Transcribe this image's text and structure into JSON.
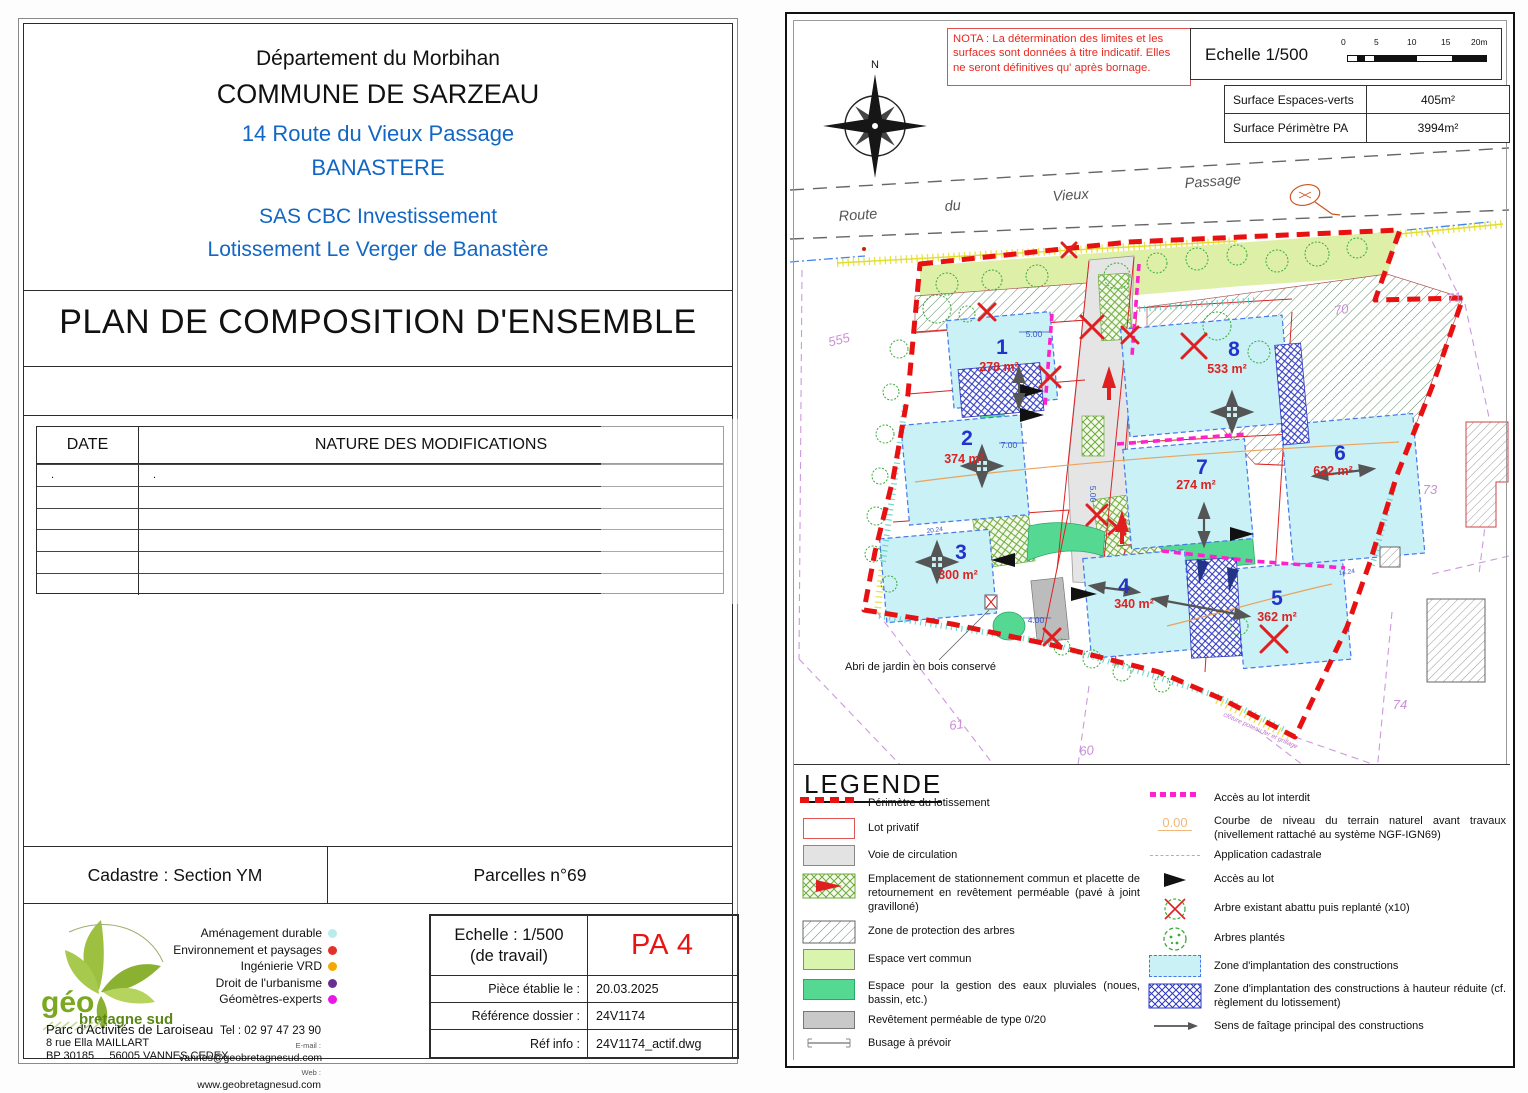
{
  "left_panel": {
    "header": {
      "line1": "Département du Morbihan",
      "line2": "COMMUNE DE SARZEAU",
      "line3": "14 Route du Vieux Passage",
      "line4": "BANASTERE",
      "line5": "SAS CBC Investissement",
      "line6": "Lotissement Le Verger de Banastère"
    },
    "title": "PLAN DE COMPOSITION D'ENSEMBLE",
    "modifications_table": {
      "col_date": "DATE",
      "col_nature": "NATURE DES MODIFICATIONS",
      "row1_date": ".",
      "row1_nature": "."
    },
    "cadastre": "Cadastre : Section YM",
    "parcelles": "Parcelles n°69",
    "logo": {
      "name": "géo",
      "sub": "bretagne sud"
    },
    "services": [
      {
        "label": "Aménagement durable",
        "color": "#b8ecec"
      },
      {
        "label": "Environnement et paysages",
        "color": "#e23128"
      },
      {
        "label": "Ingénierie VRD",
        "color": "#f5a800"
      },
      {
        "label": "Droit de l'urbanisme",
        "color": "#6a2d91"
      },
      {
        "label": "Géomètres-experts",
        "color": "#e619e6"
      }
    ],
    "contact": {
      "line1": "Parc d'Activités de Laroiseau",
      "line2": "8 rue Ella MAILLART",
      "line3a": "BP 30185",
      "line3b": "56005 VANNES CEDEX",
      "tel": "Tel : 02 97 47 23 90",
      "email_label": "E-mail :",
      "email": "vannes@geobretagnesud.com",
      "web_label": "Web :",
      "web": "www.geobretagnesud.com"
    },
    "info_table": {
      "echelle_line1": "Echelle : 1/500",
      "echelle_line2": "(de travail)",
      "doc_code": "PA 4",
      "rows": [
        {
          "label": "Pièce établie le :",
          "value": "20.03.2025"
        },
        {
          "label": "Référence dossier :",
          "value": "24V1174"
        },
        {
          "label": "Réf info :",
          "value": "24V1174_actif.dwg"
        }
      ]
    }
  },
  "right_panel": {
    "nota": "NOTA : La détermination des limites et les surfaces sont données à titre indicatif. Elles ne  seront définitives qu' après bornage.",
    "scale": {
      "label": "Echelle 1/500",
      "ticks": [
        "0",
        "5",
        "10",
        "15",
        "20m"
      ]
    },
    "surface_table": [
      {
        "label": "Surface Espaces-verts",
        "value": "405m²"
      },
      {
        "label": "Surface Périmètre PA",
        "value": "3994m²"
      }
    ],
    "compass": "N",
    "road_words": [
      "Route",
      "du",
      "Vieux",
      "Passage"
    ],
    "lots": [
      {
        "num": "1",
        "area": "278 m²"
      },
      {
        "num": "2",
        "area": "374 m²"
      },
      {
        "num": "3",
        "area": "300 m²"
      },
      {
        "num": "4",
        "area": "340 m²"
      },
      {
        "num": "5",
        "area": "362 m²"
      },
      {
        "num": "6",
        "area": "622 m²"
      },
      {
        "num": "7",
        "area": "274 m²"
      },
      {
        "num": "8",
        "area": "533 m²"
      }
    ],
    "parcels": [
      "555",
      "70",
      "71",
      "73",
      "74",
      "61",
      "60"
    ],
    "dims": [
      "5.00",
      "7.00",
      "4.00",
      "5.00",
      "20.24",
      "14.24"
    ],
    "abri_label": "Abri de jardin en bois conservé",
    "fence_label": "clôture poteau fer et grillage",
    "legend": {
      "title": "LEGENDE",
      "left": [
        {
          "label": "Périmètre du lotissement"
        },
        {
          "label": "Lot privatif"
        },
        {
          "label": "Voie de circulation"
        },
        {
          "label": "Emplacement de stationnement commun et placette de retournement en revêtement perméable (pavé à joint gravilloné)"
        },
        {
          "label": "Zone de protection des arbres"
        },
        {
          "label": "Espace vert commun"
        },
        {
          "label": "Espace pour la gestion des eaux pluviales (noues, bassin, etc.)"
        },
        {
          "label": "Revêtement perméable de type 0/20"
        },
        {
          "label": "Busage à prévoir"
        }
      ],
      "right": [
        {
          "label": "Accès au lot interdit"
        },
        {
          "label": "Courbe de niveau du terrain naturel avant travaux (nivellement rattaché au système NGF-IGN69)",
          "value": "0.00"
        },
        {
          "label": "Application cadastrale"
        },
        {
          "label": "Accès au lot"
        },
        {
          "label": "Arbre existant abattu puis replanté (x10)"
        },
        {
          "label": "Arbres plantés"
        },
        {
          "label": "Zone d'implantation des constructions"
        },
        {
          "label": "Zone d'implantation des constructions à hauteur réduite (cf. règlement du lotissement)"
        },
        {
          "label": "Sens de faîtage principal des constructions"
        }
      ]
    }
  },
  "colors": {
    "heading_blue": "#1266c4",
    "doc_code_red": "#e81414",
    "perimeter_red": "#e81111",
    "construction_zone_cyan": "#c9f1f6",
    "espace_vert_green": "#def0a8",
    "eaux_pluviales_green": "#55d992",
    "access_forbidden_magenta": "#ff22cc",
    "cadastral_purple": "#cc99dd",
    "contour_orange": "#eaa35c",
    "lot_number_blue": "#2233cc",
    "lot_area_red": "#dd2222"
  }
}
